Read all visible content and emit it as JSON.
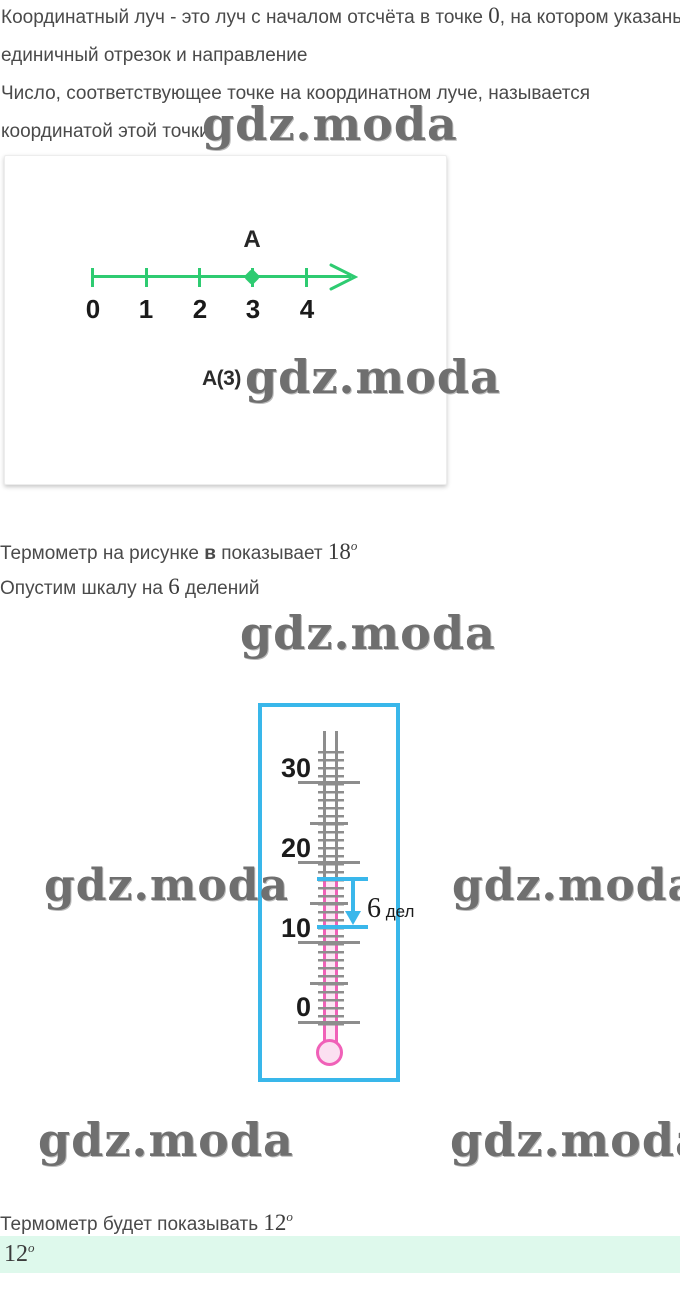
{
  "watermark_text": "gdz.moda",
  "intro": {
    "l1a": "Координатный луч - это луч с началом отсчёта в точке ",
    "l1_num": "0",
    "l1b": ", на котором указаны",
    "l2": "единичный отрезок и направление",
    "l3": "Число, соответствующее точке на координатном луче, называется",
    "l4": "координатой этой точки"
  },
  "ray_figure": {
    "line_color": "#2ecb71",
    "tick_labels": [
      "0",
      "1",
      "2",
      "3",
      "4"
    ],
    "point_name": "A",
    "point_coordinate": 3,
    "caption": "A(3)"
  },
  "thermo_text": {
    "p1a": "Термометр на рисунке ",
    "p1_bold": "в",
    "p1b": " показывает ",
    "p1_value": "18",
    "p1_sup": "o",
    "p2a": "Опустим шкалу на ",
    "p2_num": "6",
    "p2b": " делений"
  },
  "thermometer": {
    "scale_labels": [
      "30",
      "20",
      "10",
      "0"
    ],
    "reading_degrees": 18,
    "drop_divisions": 6,
    "result_degrees": 12,
    "annotation_num": "6",
    "annotation_unit": "дел",
    "colors": {
      "frame": "#39b7ea",
      "marker": "#3ab7eb",
      "liquid": "#f061b8",
      "ticks": "#8d8d8d"
    }
  },
  "result": {
    "p1a": "Термометр будет показывать ",
    "p1_value": "12",
    "p1_sup": "o",
    "answer_value": "12",
    "answer_sup": "o",
    "highlight_color": "#def9ec"
  }
}
